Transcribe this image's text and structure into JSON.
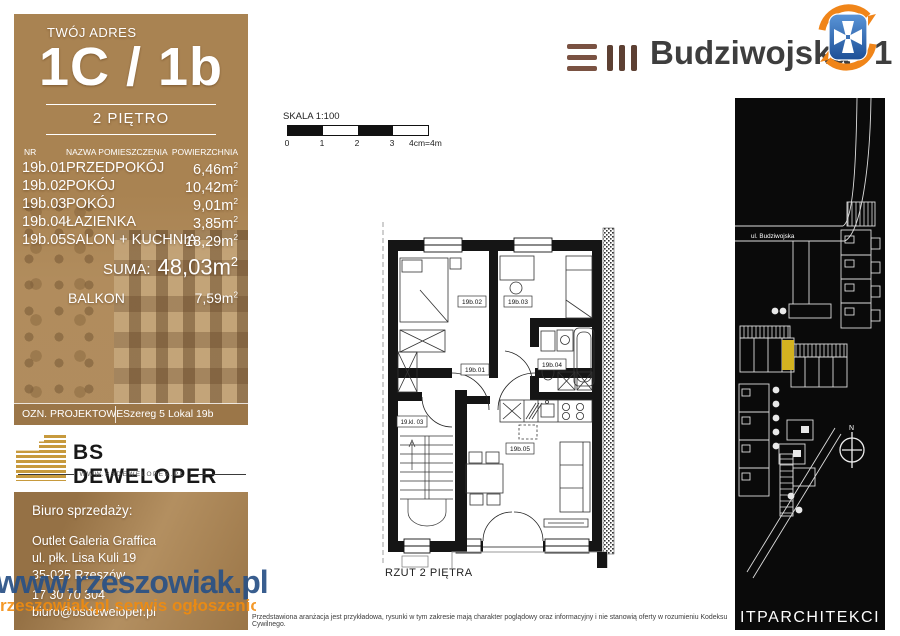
{
  "left_panel": {
    "address_label": "TWÓJ ADRES",
    "unit": "1C / 1b",
    "floor": "2 PIĘTRO",
    "table": {
      "col_nr": "NR",
      "col_name": "NAZWA POMIESZCZENIA",
      "col_area": "POWIERZCHNIA",
      "sup": "2",
      "rows": [
        {
          "nr": "19b.01",
          "name": "PRZEDPOKÓJ",
          "area": "6,46m"
        },
        {
          "nr": "19b.02",
          "name": "POKÓJ",
          "area": "10,42m"
        },
        {
          "nr": "19b.03",
          "name": "POKÓJ",
          "area": "9,01m"
        },
        {
          "nr": "19b.04",
          "name": "ŁAZIENKA",
          "area": "3,85m"
        },
        {
          "nr": "19b.05",
          "name": "SALON + KUCHNIA",
          "area": "18,29m"
        }
      ],
      "suma_label": "SUMA:",
      "suma_value": "48,03m",
      "balkon_label": "BALKON",
      "balkon_value": "7,59m"
    },
    "ozn_label": "OZN. PROJEKTOWE",
    "ozn_value": "Szereg 5 Lokal 19b"
  },
  "developer": {
    "name": "BS DEWELOPER",
    "website": "WWW.BSDEWELOPER.PL"
  },
  "office": {
    "title": "Biuro sprzedaży:",
    "line1": "Outlet Galeria Graffica",
    "line2": "ul. płk. Lisa Kuli 19",
    "line3": "35-025 Rzeszów",
    "phone": "17 30 70 304",
    "email": "biuro@bsdeweloper.pl"
  },
  "watermark": {
    "blue": "www.rzeszowiak.pl",
    "orange": "rzeszowiak.pl serwis ogłoszeniowy"
  },
  "brand": {
    "name": "Budziwojska",
    "number": "1"
  },
  "scalebar": {
    "label": "SKALA 1:100",
    "t0": "0",
    "t1": "1",
    "t2": "2",
    "t3": "3",
    "end": "4cm=4m"
  },
  "plan": {
    "caption": "RZUT 2 PIĘTRA",
    "labels": {
      "r01": "19b.01",
      "r02": "19b.02",
      "r03": "19b.03",
      "r04": "19b.04",
      "r05": "19b.05",
      "stairs": "19.kl. 03"
    }
  },
  "map": {
    "street": "ul. Budziwojska",
    "compass": "N",
    "studio": "ITPARCHITEKCI"
  },
  "disclaimer": "Przedstawiona aranżacja jest przykładowa, rysunki w tym zakresie mają charakter poglądowy oraz informacyjny i nie stanowią oferty w rozumieniu Kodeksu Cywilnego.",
  "colors": {
    "panel_brown": "#a98352",
    "map_bg": "#0a0a0a",
    "highlight_yellow": "#d3b220",
    "gold": "#c79a3d",
    "wm_blue": "#285086",
    "wm_orange": "#f28b0b",
    "emblem_blue": "#2f6bbf",
    "emblem_orange": "#f08519"
  }
}
